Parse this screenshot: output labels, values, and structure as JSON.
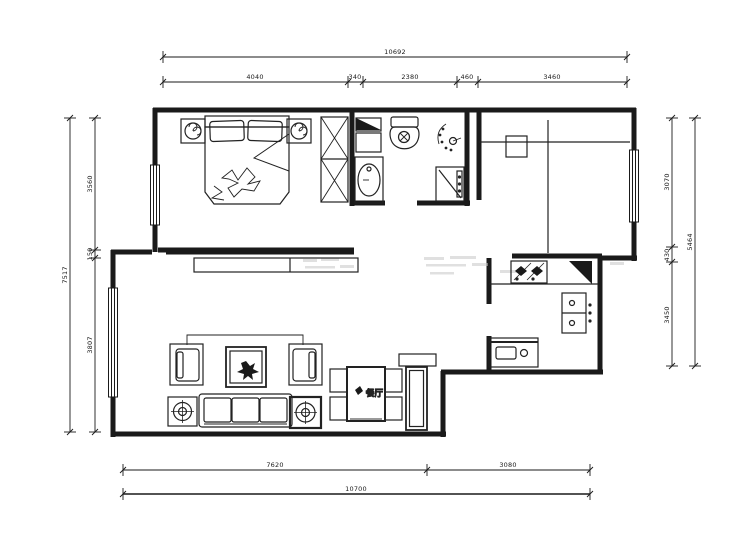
{
  "drawing": {
    "type": "floor-plan",
    "labels": {
      "dining_room": "餐厅"
    },
    "dimensions": {
      "top_total": "10692",
      "top_segments": [
        "4040",
        "340",
        "2380",
        "460",
        "3460"
      ],
      "left_total": "7517",
      "left_segments": [
        "3560",
        "150",
        "3807"
      ],
      "right_total": "5464",
      "right_segments": [
        "3070",
        "430",
        "3450"
      ],
      "bottom_segments": [
        "7620",
        "3080"
      ],
      "bottom_total": "10700"
    },
    "colors": {
      "line": "#1a1a1a",
      "furniture": "#222222",
      "watermark": "#c8c8c8",
      "background": "#ffffff"
    }
  }
}
